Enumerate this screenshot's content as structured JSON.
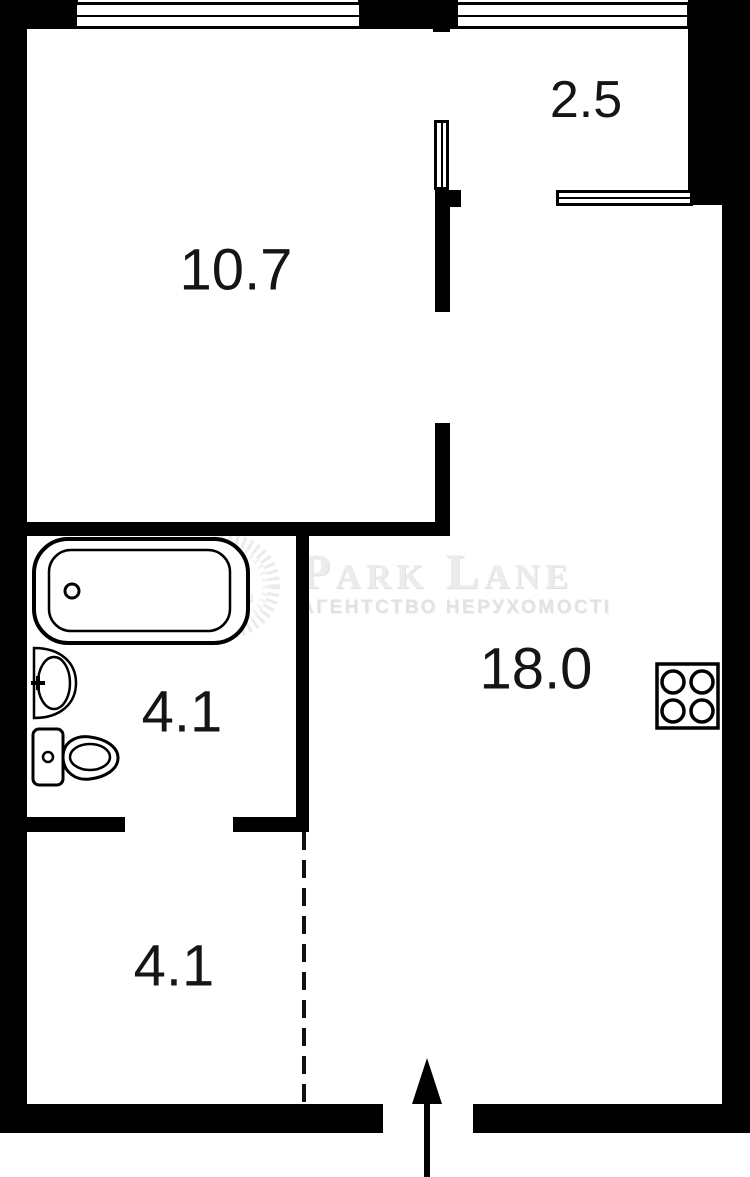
{
  "plan": {
    "type": "apartment-floor-plan",
    "rooms": [
      {
        "name": "room-upper",
        "area": "10.7"
      },
      {
        "name": "balcony",
        "area": "2.5"
      },
      {
        "name": "bathroom",
        "area": "4.1"
      },
      {
        "name": "living-kitchen",
        "area": "18.0"
      },
      {
        "name": "hallway",
        "area": "4.1"
      }
    ],
    "fixtures": [
      "bathtub-icon",
      "sink-icon",
      "toilet-icon",
      "stove-icon",
      "entrance-arrow-icon"
    ],
    "watermark": {
      "monogram": "PL",
      "title": "Park Lane",
      "subtitle": "АГЕНТСТВО НЕРУХОМОСТІ"
    },
    "colors": {
      "wall": "#000000",
      "background": "#ffffff",
      "watermark": "#ececec"
    }
  }
}
